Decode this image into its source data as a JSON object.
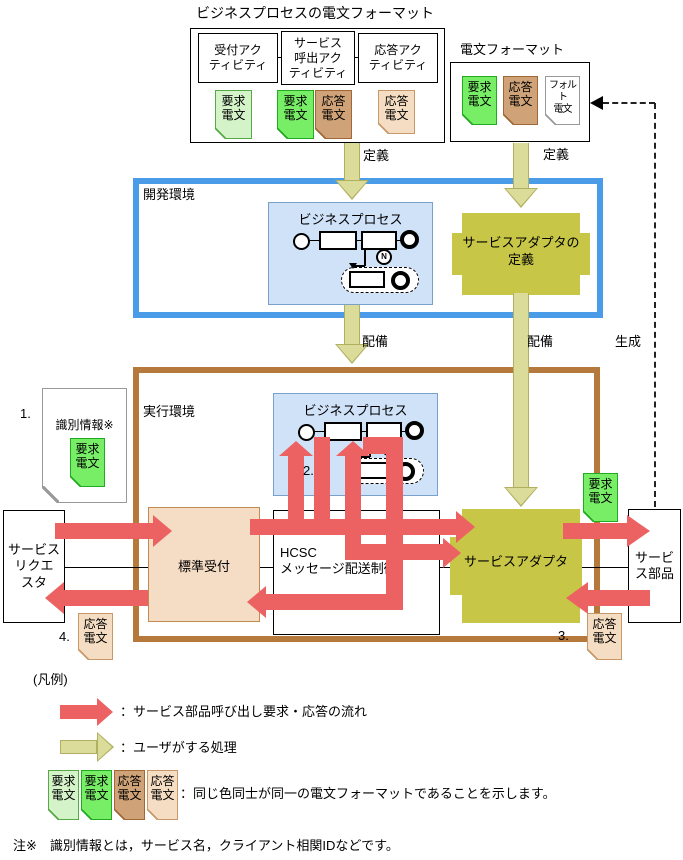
{
  "colors": {
    "red_arrow": "#ec6262",
    "yellow_arrow": "#dcdc9a",
    "olive": "#c7c646",
    "dev_border": "#4a9be8",
    "exec_border": "#b5793c",
    "bp_fill": "#cfe2f8",
    "reception_fill": "#f5dcc5"
  },
  "top": {
    "title": "ビジネスプロセスの電文フォーマット",
    "activities": [
      "受付アク\nティビティ",
      "サービス\n呼出アク\nティビティ",
      "応答アク\nティビティ"
    ],
    "docs": [
      {
        "label": "要求\n電文",
        "type": "light-green"
      },
      {
        "label": "要求\n電文",
        "type": "green"
      },
      {
        "label": "応答\n電文",
        "type": "brown"
      },
      {
        "label": "応答\n電文",
        "type": "tan"
      }
    ]
  },
  "msg_format": {
    "title": "電文フォーマット",
    "docs": [
      {
        "label": "要求\n電文",
        "type": "green"
      },
      {
        "label": "応答\n電文",
        "type": "brown"
      },
      {
        "label": "フォルト\n電文",
        "type": "white"
      }
    ]
  },
  "dev_env": {
    "label": "開発環境",
    "bp_title": "ビジネスプロセス",
    "adapter_def": "サービスアダプタの\n定義"
  },
  "exec_env": {
    "label": "実行環境",
    "bp_title": "ビジネスプロセス",
    "hcsc": "HCSC\nメッセージ配送制御",
    "reception": "標準受付",
    "adapter": "サービスアダプタ"
  },
  "edges": {
    "define_left": "定義",
    "define_right": "定義",
    "deploy_left": "配備",
    "deploy_right": "配備",
    "generate": "生成"
  },
  "steps": {
    "s1": "1.",
    "s2": "2.",
    "s3": "3.",
    "s4": "4."
  },
  "left": {
    "requester": "サービス\nリクエ\nスタ",
    "id_info": "識別情報※",
    "id_doc": "要求\n電文",
    "resp_doc": "応答\n電文"
  },
  "right": {
    "component": "サービ\nス部品",
    "req_doc": "要求\n電文",
    "resp_doc": "応答\n電文"
  },
  "misc": {
    "n_badge": "N"
  },
  "legend": {
    "title": "(凡例)",
    "red_desc": "：サービス部品呼び出し要求・応答の流れ",
    "yellow_desc": "：ユーザがする処理",
    "docs": [
      {
        "label": "要求\n電文",
        "type": "light-green"
      },
      {
        "label": "要求\n電文",
        "type": "green"
      },
      {
        "label": "応答\n電文",
        "type": "brown"
      },
      {
        "label": "応答\n電文",
        "type": "tan"
      }
    ],
    "docs_desc": "：同じ色同士が同一の電文フォーマットであることを示します。"
  },
  "note": "注※　識別情報とは，サービス名，クライアント相関IDなどです。"
}
